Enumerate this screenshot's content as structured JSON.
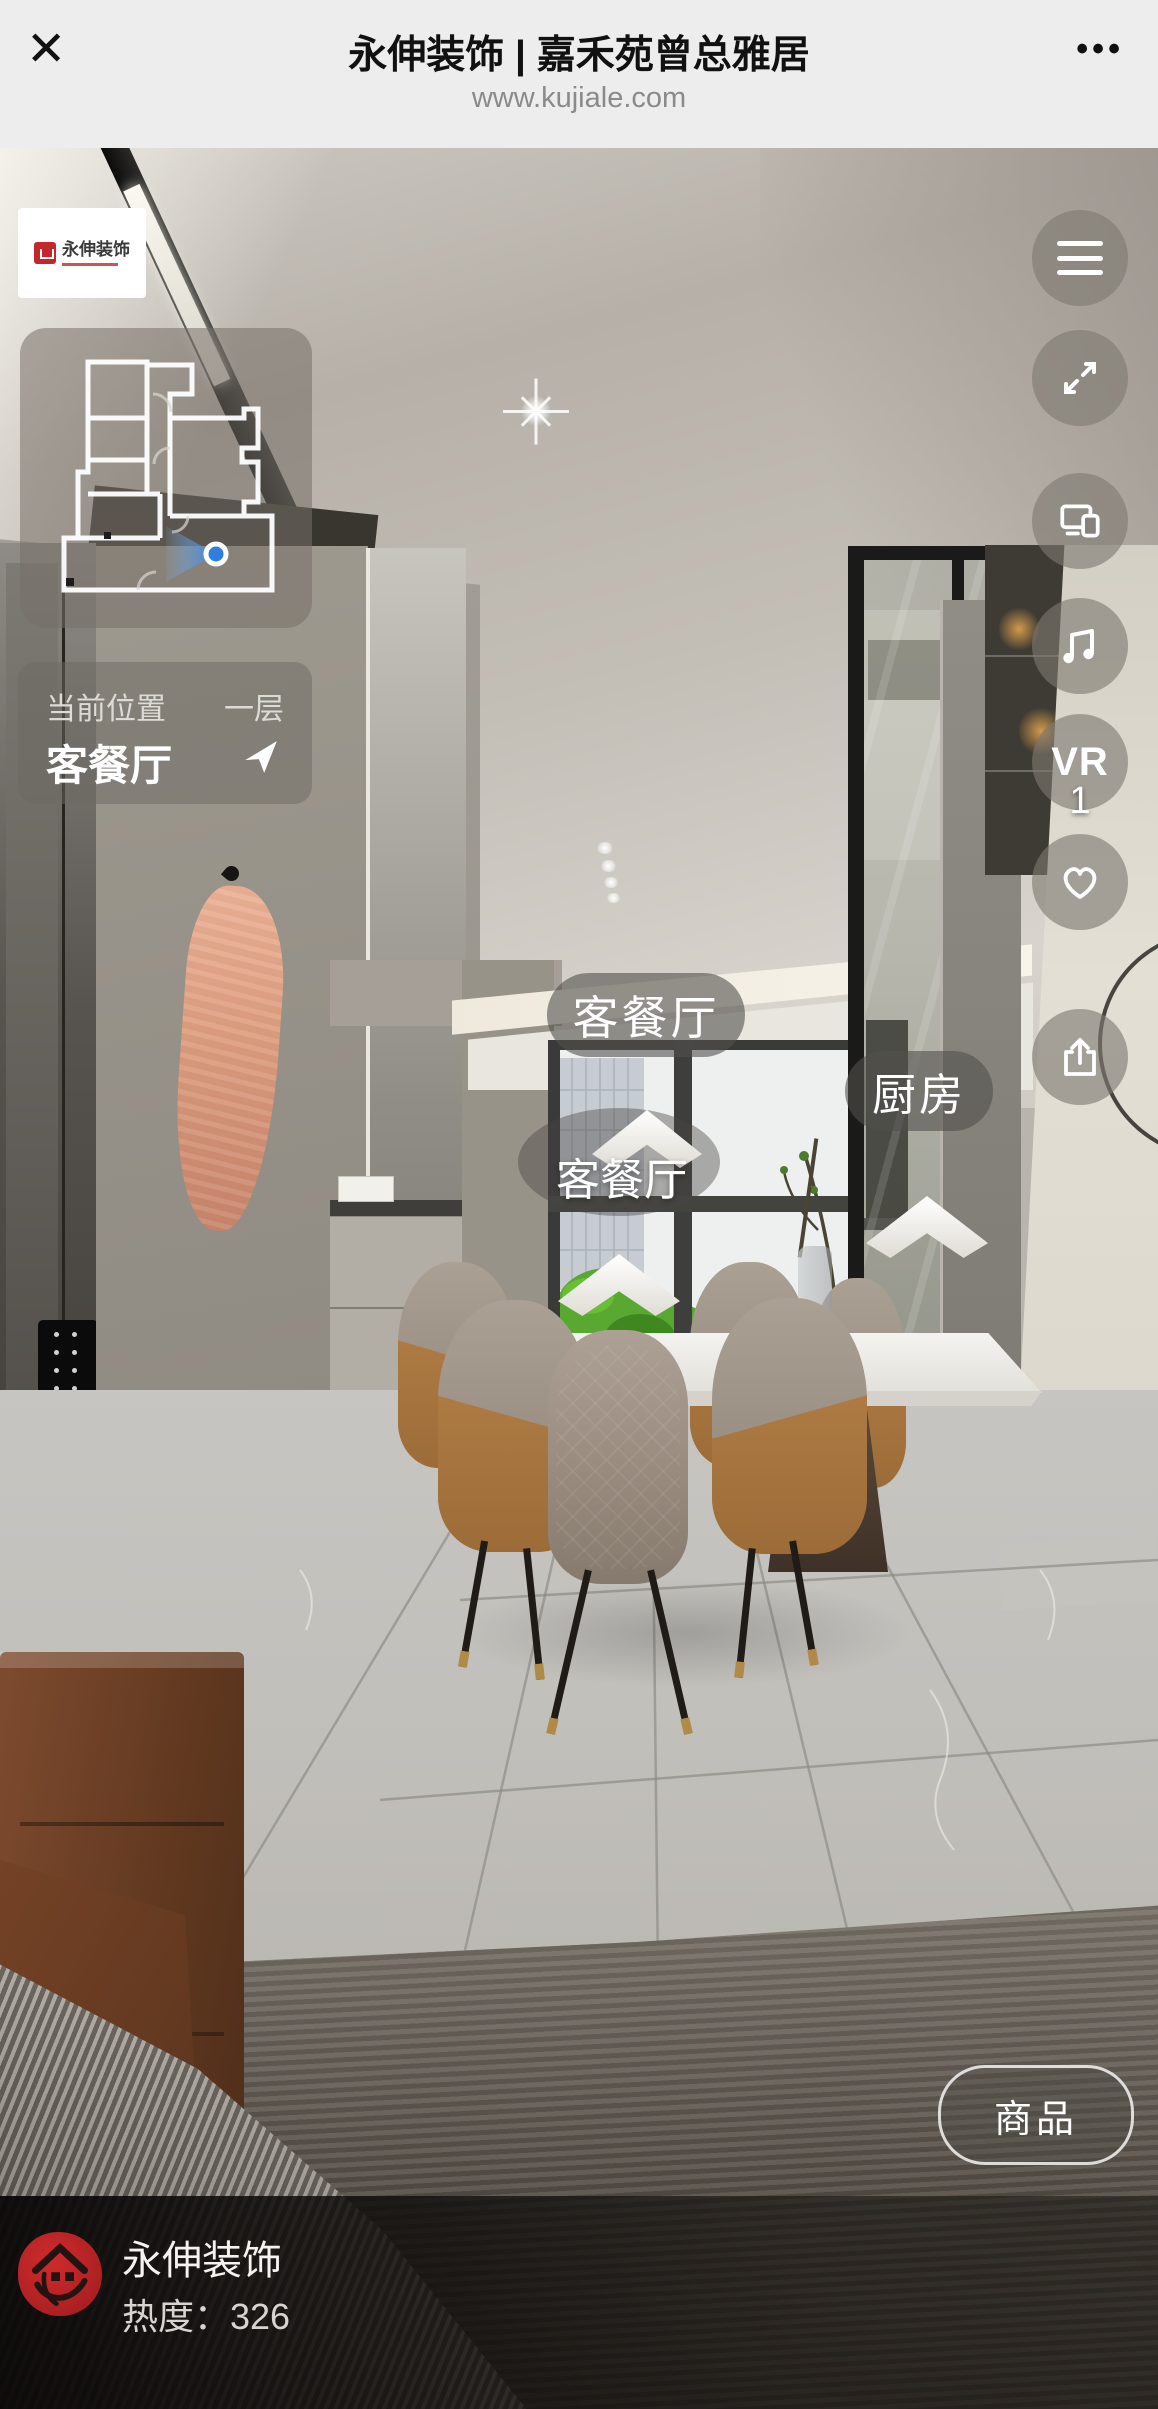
{
  "browser": {
    "close": "✕",
    "title": "永伸装饰 | 嘉禾苑曾总雅居",
    "url": "www.kujiale.com",
    "more": "•••"
  },
  "logo_card": {
    "name": "永伸装饰"
  },
  "location": {
    "label": "当前位置",
    "floor": "一层",
    "room": "客餐厅"
  },
  "toolbar": {
    "vr_label": "VR",
    "like_count": "1"
  },
  "hotspots": {
    "living_top": "客餐厅",
    "kitchen": "厨房",
    "living_walk": "客餐厅"
  },
  "products_button": {
    "label": "商品"
  },
  "footer": {
    "studio": "永伸装饰",
    "heat_label": "热度：",
    "heat_value": "326"
  },
  "colors": {
    "accent_blue": "#2f7fe0",
    "stamp_red": "#c2272d",
    "header_bg": "#ededed"
  }
}
